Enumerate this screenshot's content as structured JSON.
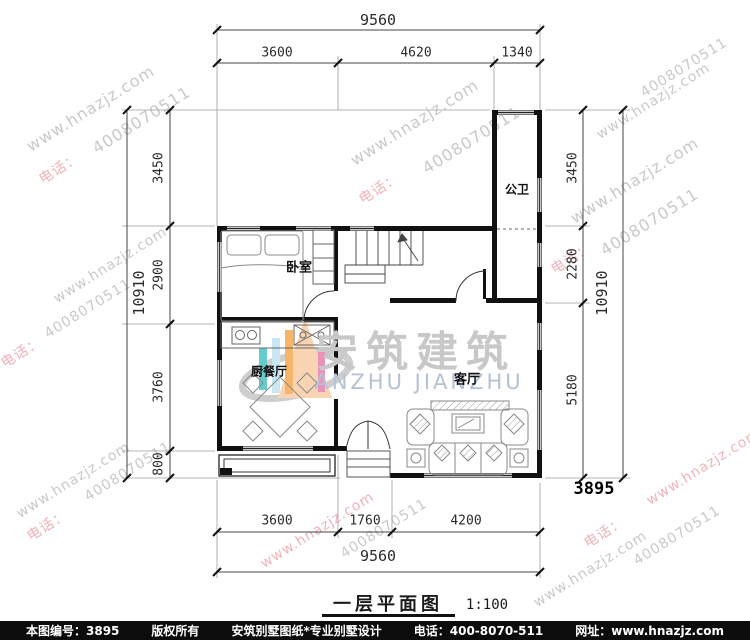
{
  "watermark": {
    "url": "www.hnazjz.com",
    "phone_label": "电话：",
    "phone_number": "4008070511",
    "colors": {
      "gray": "#c9c9c9",
      "pink": "#f0b3b8"
    }
  },
  "logo": {
    "cn": "安筑建筑",
    "en": "ANZHU JIANZHU"
  },
  "rooms": {
    "bedroom": "卧室",
    "bathroom": "公卫",
    "kitchen_dining": "厨餐厅",
    "living": "客厅"
  },
  "dims": {
    "top": {
      "total": "9560",
      "segments": [
        "3600",
        "4620",
        "1340"
      ]
    },
    "bottom": {
      "total": "9560",
      "segments": [
        "3600",
        "1760",
        "4200"
      ]
    },
    "left": {
      "total": "10910",
      "segments": [
        "3450",
        "2900",
        "3760",
        "800"
      ]
    },
    "right": {
      "total": "10910",
      "segments": [
        "3450",
        "2280",
        "5180"
      ],
      "plan_number": "3895"
    }
  },
  "title": {
    "name": "一层平面图",
    "scale": "1:100"
  },
  "footer": {
    "sheet_no": "本图编号：3895",
    "copyright": "版权所有",
    "studio": "安筑别墅图纸*专业别墅设计",
    "phone": "电话：400-8070-511",
    "site": "网址：www.hnazjz.com"
  }
}
